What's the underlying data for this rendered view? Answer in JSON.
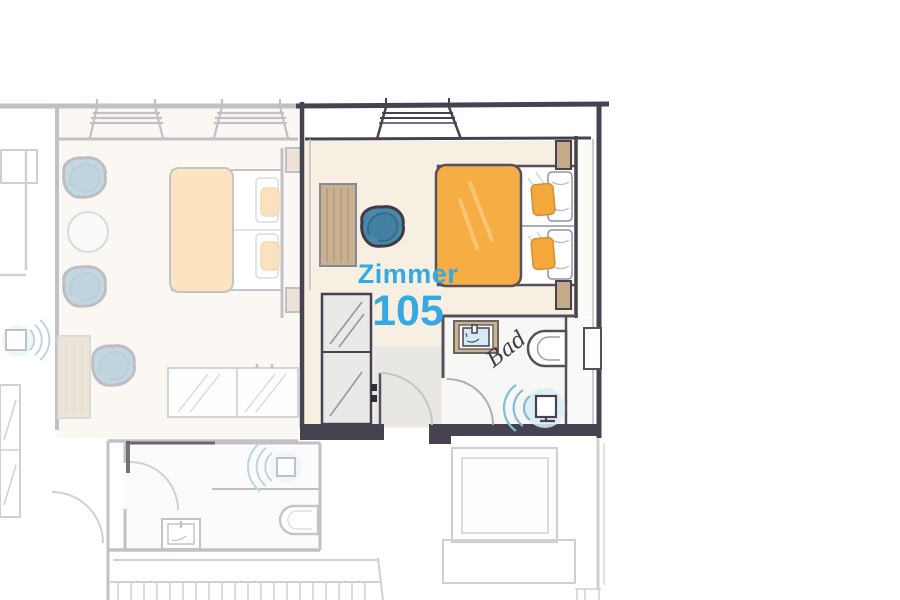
{
  "floorplan": {
    "room": {
      "label": "Zimmer",
      "number": "105"
    },
    "bathroom": {
      "label": "Bad"
    },
    "colors": {
      "accent_text": "#36a9e1",
      "wall_dark": "#474250",
      "room_floor": "#f6efe2",
      "duvet_orange": "#f6ae44",
      "pillow_orange": "#f3a73c",
      "wood_tan": "#c8b190",
      "armchair_teal": "#4b87a6",
      "water_arc_blue": "#7fbede",
      "faded_line_gray": "#6d7480"
    }
  }
}
